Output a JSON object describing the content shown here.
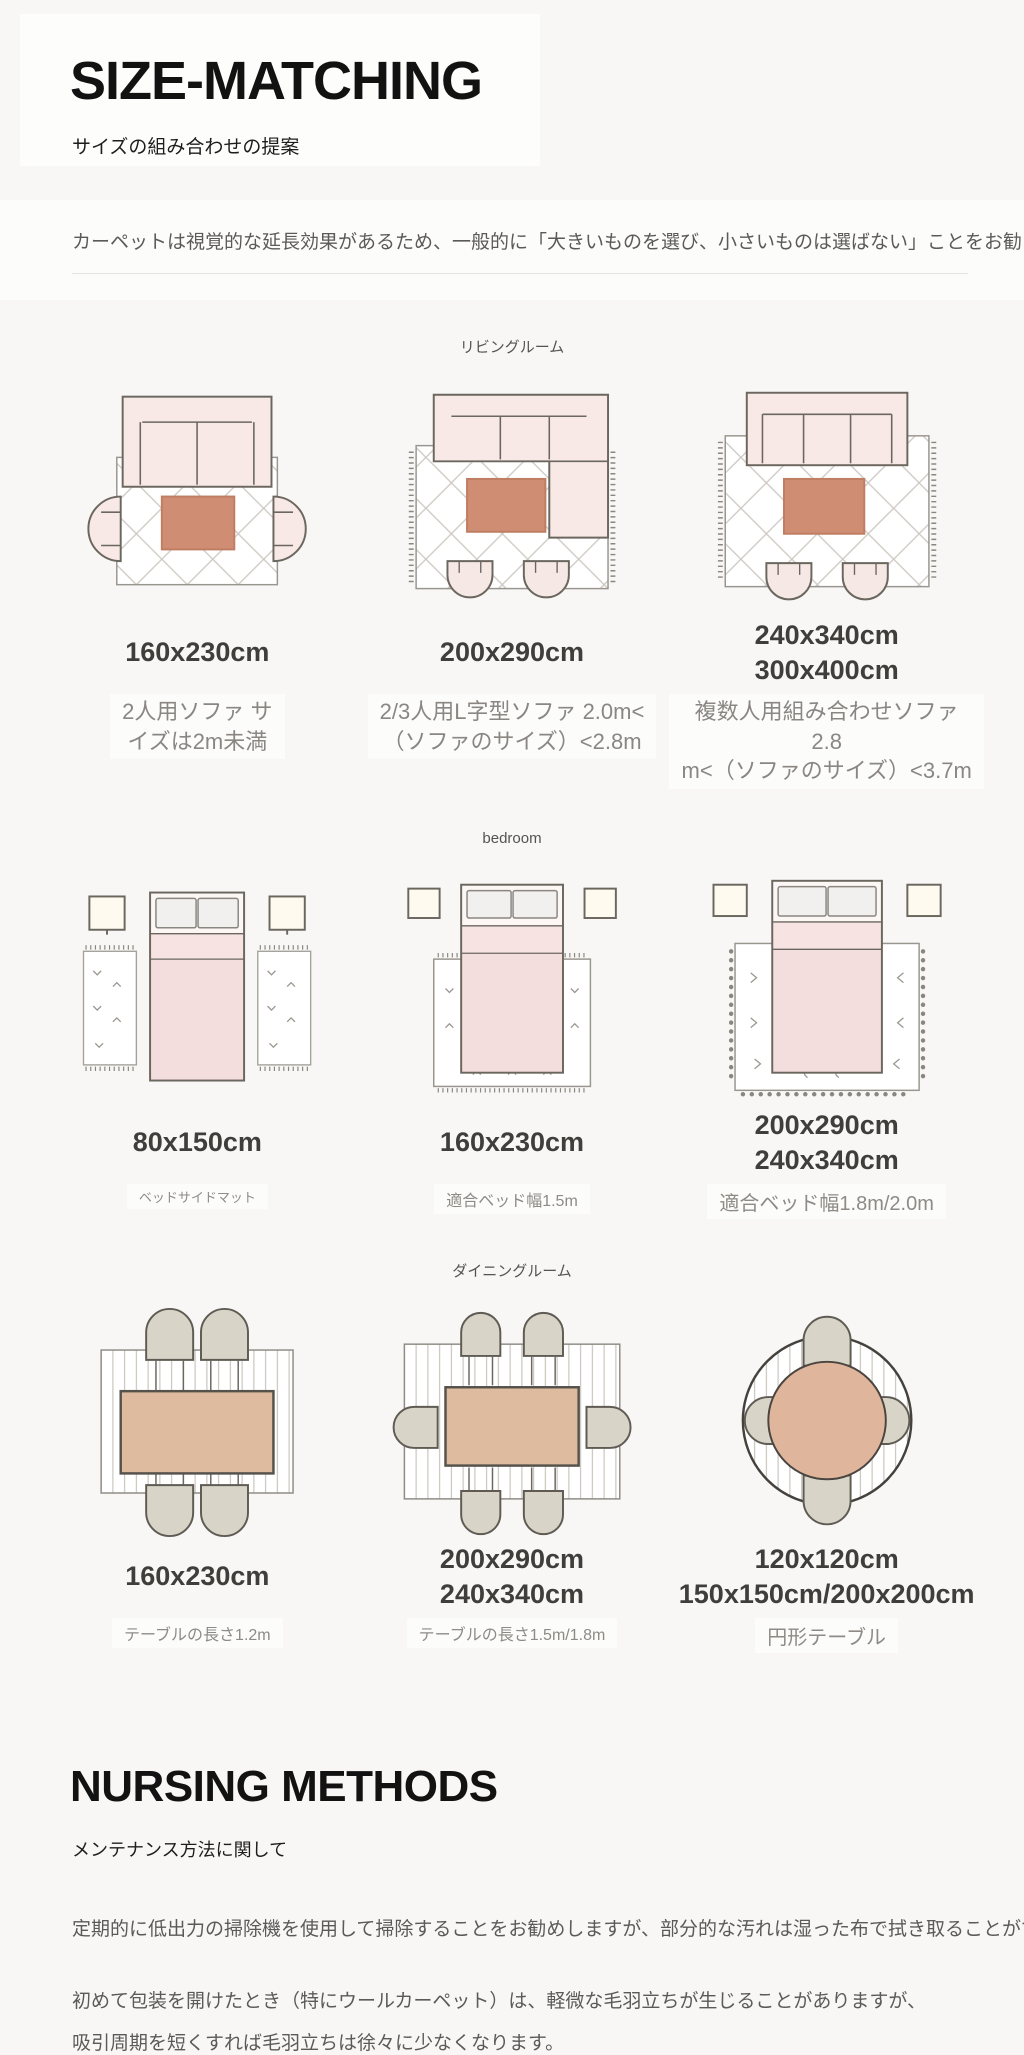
{
  "header": {
    "title": "SIZE-MATCHING",
    "subtitle": "サイズの組み合わせの提案",
    "intro": "カーペットは視覚的な延長効果があるため、一般的に「大きいものを選び、小さいものは選ばない」ことをお勧"
  },
  "sections": [
    {
      "label": "リビングルーム",
      "items": [
        {
          "sizes": "160x230cm",
          "desc": "2人用ソファ サ\nイズは2m未満",
          "illustration": "two-seater-sofa-with-rug-top-view"
        },
        {
          "sizes": "200x290cm",
          "desc": "2/3人用L字型ソファ 2.0m<\n（ソファのサイズ）<2.8m",
          "illustration": "l-shaped-sofa-with-rug-top-view"
        },
        {
          "sizes": "240x340cm\n300x400cm",
          "desc": "複数人用組み合わせソファ 2.8\nm<（ソファのサイズ）<3.7m",
          "illustration": "combination-sofa-with-rug-top-view"
        }
      ]
    },
    {
      "label": "bedroom",
      "items": [
        {
          "sizes": "80x150cm",
          "desc": "ベッドサイドマット",
          "illustration": "bed-with-two-bedside-mats-top-view"
        },
        {
          "sizes": "160x230cm",
          "desc": "適合ベッド幅1.5m",
          "illustration": "bed-on-rug-top-view"
        },
        {
          "sizes": "200x290cm\n240x340cm",
          "desc": "適合ベッド幅1.8m/2.0m",
          "illustration": "bed-on-large-rug-top-view"
        }
      ]
    },
    {
      "label": "ダイニングルーム",
      "items": [
        {
          "sizes": "160x230cm",
          "desc": "テーブルの長さ1.2m",
          "illustration": "dining-table-four-chairs-on-rug-top-view"
        },
        {
          "sizes": "200x290cm\n240x340cm",
          "desc": "テーブルの長さ1.5m/1.8m",
          "illustration": "dining-table-six-chairs-on-rug-top-view"
        },
        {
          "sizes": "120x120cm\n150x150cm/200x200cm",
          "desc": "円形テーブル",
          "illustration": "round-table-four-chairs-on-round-rug-top-view"
        }
      ]
    }
  ],
  "care": {
    "title": "NURSING METHODS",
    "subtitle": "メンテナンス方法に関して",
    "paragraphs": [
      "定期的に低出力の掃除機を使用して掃除することをお勧めしますが、部分的な汚れは湿った布で拭き取ることができます。",
      "初めて包装を開けたとき（特にウールカーペット）は、軽微な毛羽立ちが生じることがありますが、",
      "吸引周期を短くすれば毛羽立ちは徐々に少なくなります。"
    ]
  },
  "colors": {
    "sofa_pink": "#f8e9e6",
    "coffee_table_terracotta": "#cf8e74",
    "bed_pink": "#f3dddd",
    "dining_table_tan": "#debb9e",
    "chair_greige": "#d8d5c8",
    "outline_gray": "#6b675f",
    "rug_pattern_gray": "#ccc7c1"
  }
}
